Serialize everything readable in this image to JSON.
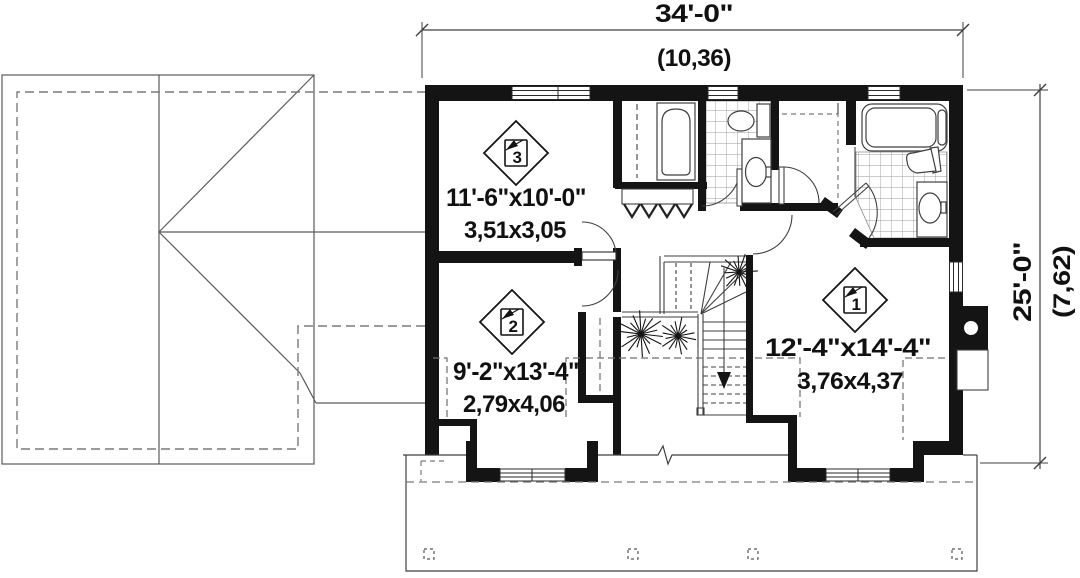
{
  "plan": {
    "title": "second-floor-plan",
    "dim_top": {
      "imperial": "34'-0\"",
      "metric": "(10,36)"
    },
    "dim_side": {
      "imperial": "25'-0\"",
      "metric": "(7,62)"
    },
    "rooms": [
      {
        "badge": "1",
        "imperial": "12'-4\"x14'-4\"",
        "metric": "3,76x4,37"
      },
      {
        "badge": "2",
        "imperial": "9'-2\"x13'-4\"",
        "metric": "2,79x4,06"
      },
      {
        "badge": "3",
        "imperial": "11'-6\"x10'-0\"",
        "metric": "3,51x3,05"
      }
    ],
    "icons": [
      "bathtub-icon",
      "toilet-icon",
      "sink-icon",
      "window-icon",
      "door-swing-icon",
      "bifold-door-icon",
      "closet-rod-icon",
      "staircase-icon",
      "down-arrow-icon",
      "plant-icon",
      "fireplace-icon",
      "porch-post-icon",
      "roof-outline-icon",
      "break-line-icon"
    ],
    "colors": {
      "wall": "#141414",
      "line": "#3f3f3f",
      "dashed": "#7a7a7a",
      "tile": "#999999",
      "background": "#ffffff",
      "text": "#111111"
    }
  }
}
